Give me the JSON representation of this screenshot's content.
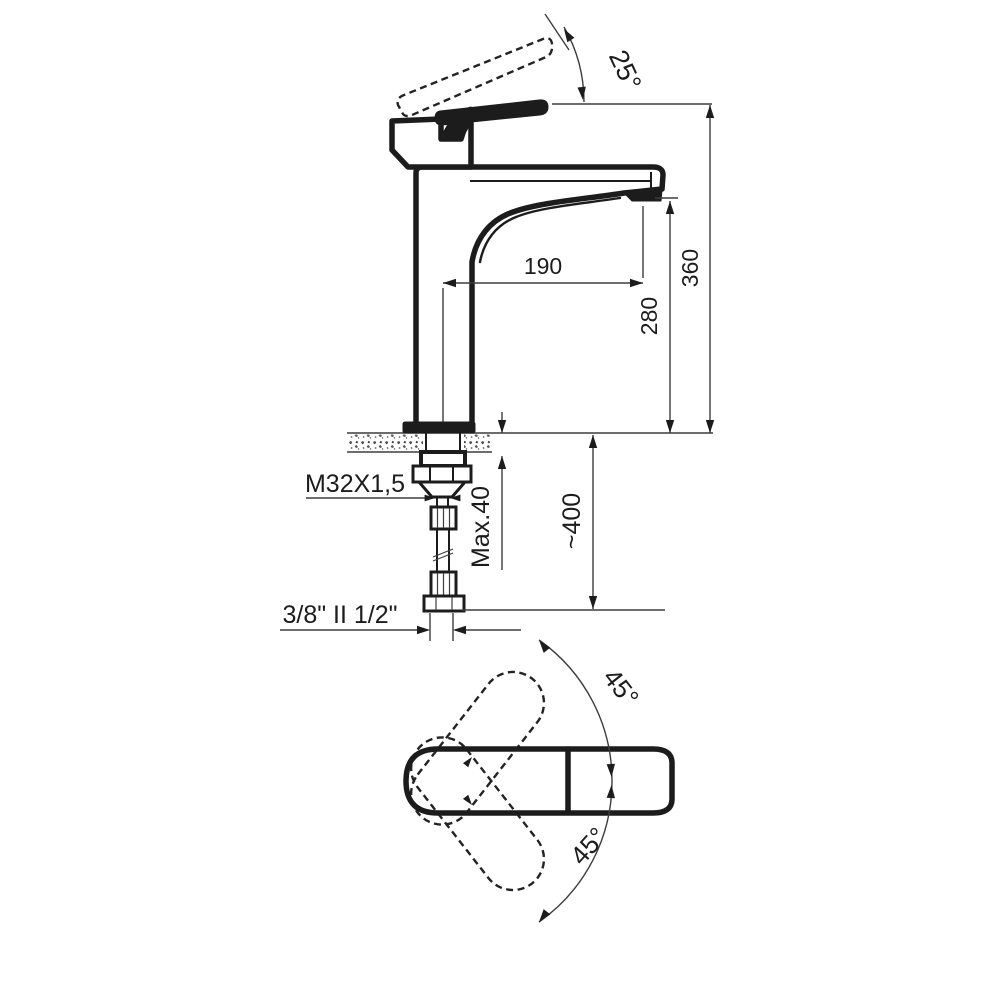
{
  "drawing": {
    "type": "technical-dimension-drawing",
    "subject": "single-lever basin mixer faucet, side view and top view",
    "colors": {
      "background": "#ffffff",
      "line": "#1c1c1c"
    },
    "side_view": {
      "lever_angle": "25°",
      "spout_reach": "190",
      "spout_height": "280",
      "total_height": "360",
      "thread_label": "M32X1,5",
      "max_mounting_thickness": "Max.40",
      "hose_length": "~400",
      "connection_label": "3/8\" II 1/2\""
    },
    "top_view": {
      "swivel_angle_upper": "45°",
      "swivel_angle_lower": "45°"
    }
  }
}
